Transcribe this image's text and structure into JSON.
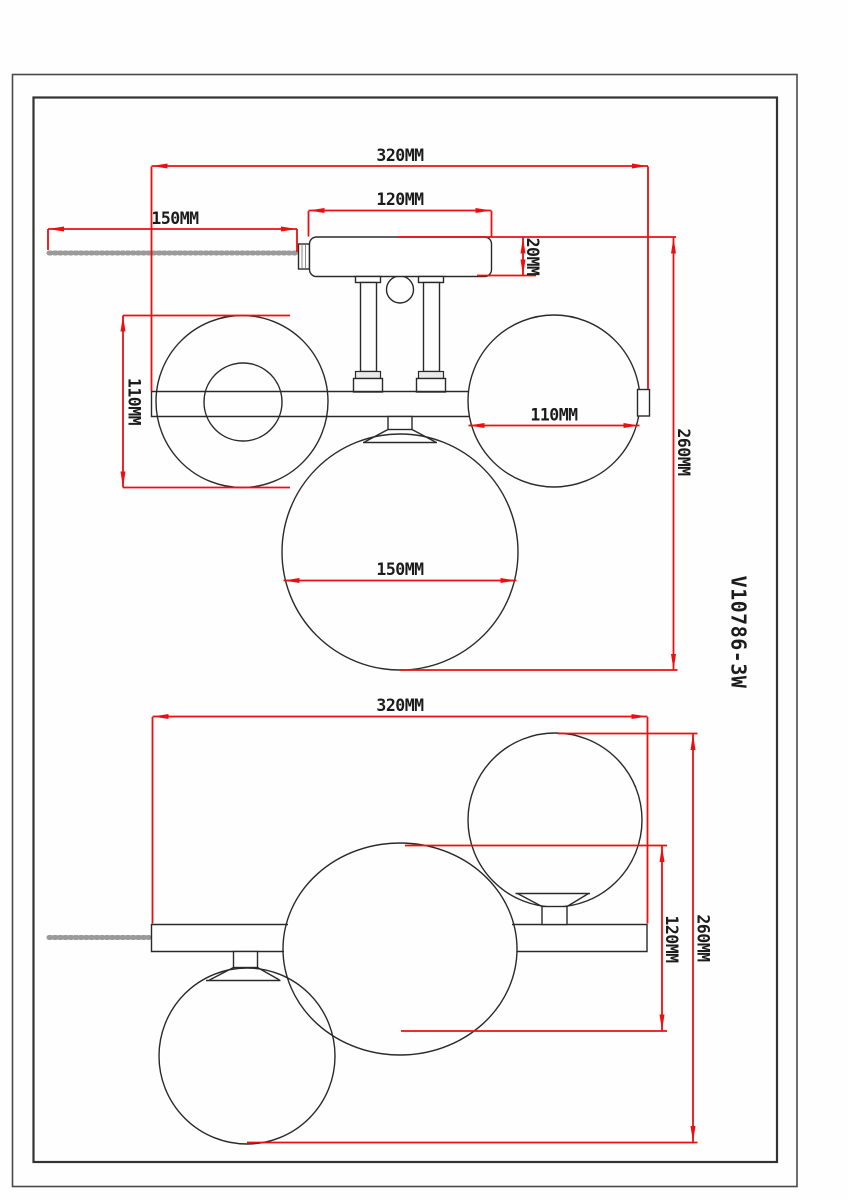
{
  "drawing": {
    "part_number": "V10786-3W",
    "front_view": {
      "overall_width": "320MM",
      "canopy_width": "120MM",
      "chain_length": "150MM",
      "canopy_height": "20MM",
      "left_globe_diameter": "110MM",
      "right_globe_diameter": "110MM",
      "overall_height": "260MM",
      "center_globe_diameter": "150MM"
    },
    "top_view": {
      "overall_width": "320MM",
      "overall_depth": "260MM",
      "globe_offset": "120MM"
    }
  },
  "colors": {
    "dimension_red": "#ed0e10",
    "outline_black": "#2a2a2a",
    "chain_gray": "#9a9a9a"
  }
}
